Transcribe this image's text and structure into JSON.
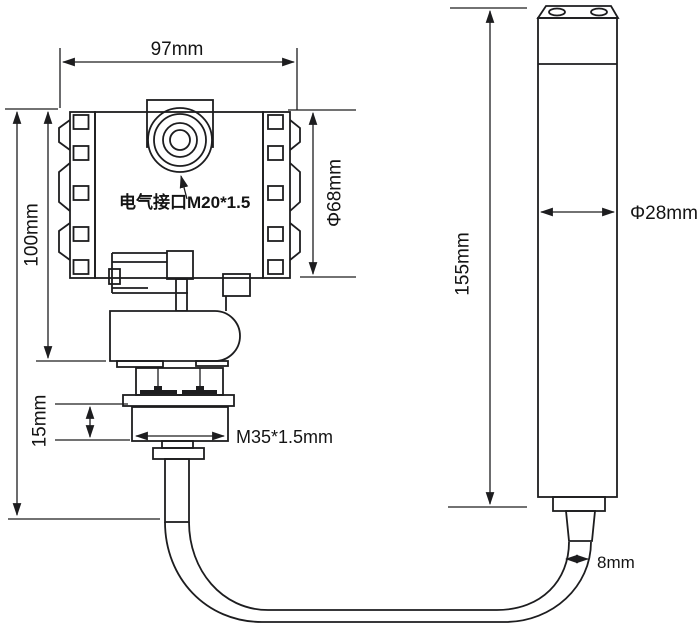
{
  "diagram": {
    "background": "#ffffff",
    "line_color": "#1d1d1f",
    "transmitter": {
      "width": "97mm",
      "body_height": "100mm",
      "body_diameter": "Φ68mm",
      "electrical_port": "电气接口M20*1.5",
      "thread_length": "15mm",
      "thread_spec": "M35*1.5mm"
    },
    "probe": {
      "length": "155mm",
      "diameter": "Φ28mm"
    },
    "cable": {
      "diameter": "8mm"
    }
  }
}
